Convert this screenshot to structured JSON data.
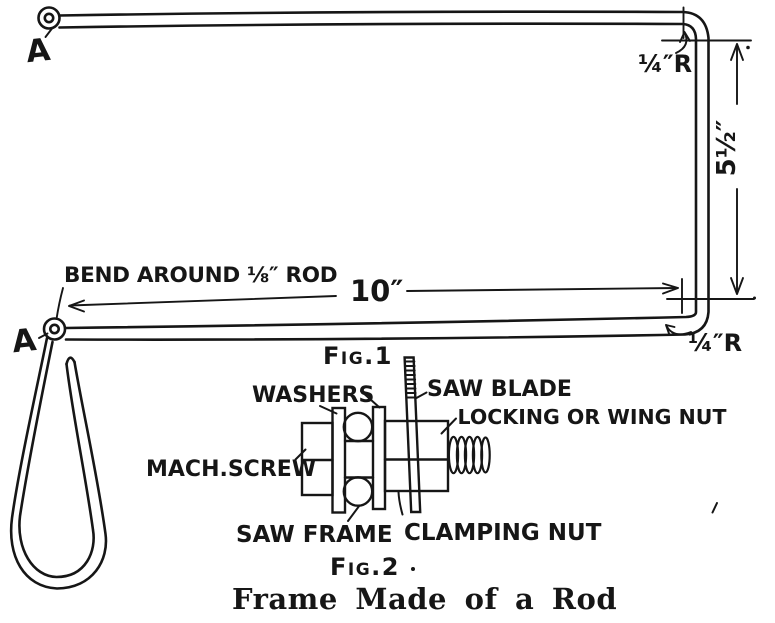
{
  "colors": {
    "ink": "#161616",
    "paper": "#ffffff"
  },
  "fig1": {
    "label": "Fig.1",
    "end_label_top": "A",
    "end_label_bottom": "A",
    "bend_note": "BEND AROUND ⅛″ ROD",
    "width_dim": "10″",
    "height_dim": "5½″",
    "corner_radius_top": "¼″R",
    "corner_radius_bottom": "¼″R"
  },
  "fig2": {
    "label": "Fig.2",
    "washers": "WASHERS",
    "saw_blade": "SAW BLADE",
    "locking_nut": "LOCKING OR WING NUT",
    "mach_screw": "MACH.SCREW",
    "saw_frame": "SAW FRAME",
    "clamping_nut": "CLAMPING NUT"
  },
  "caption": "Frame Made of a Rod"
}
